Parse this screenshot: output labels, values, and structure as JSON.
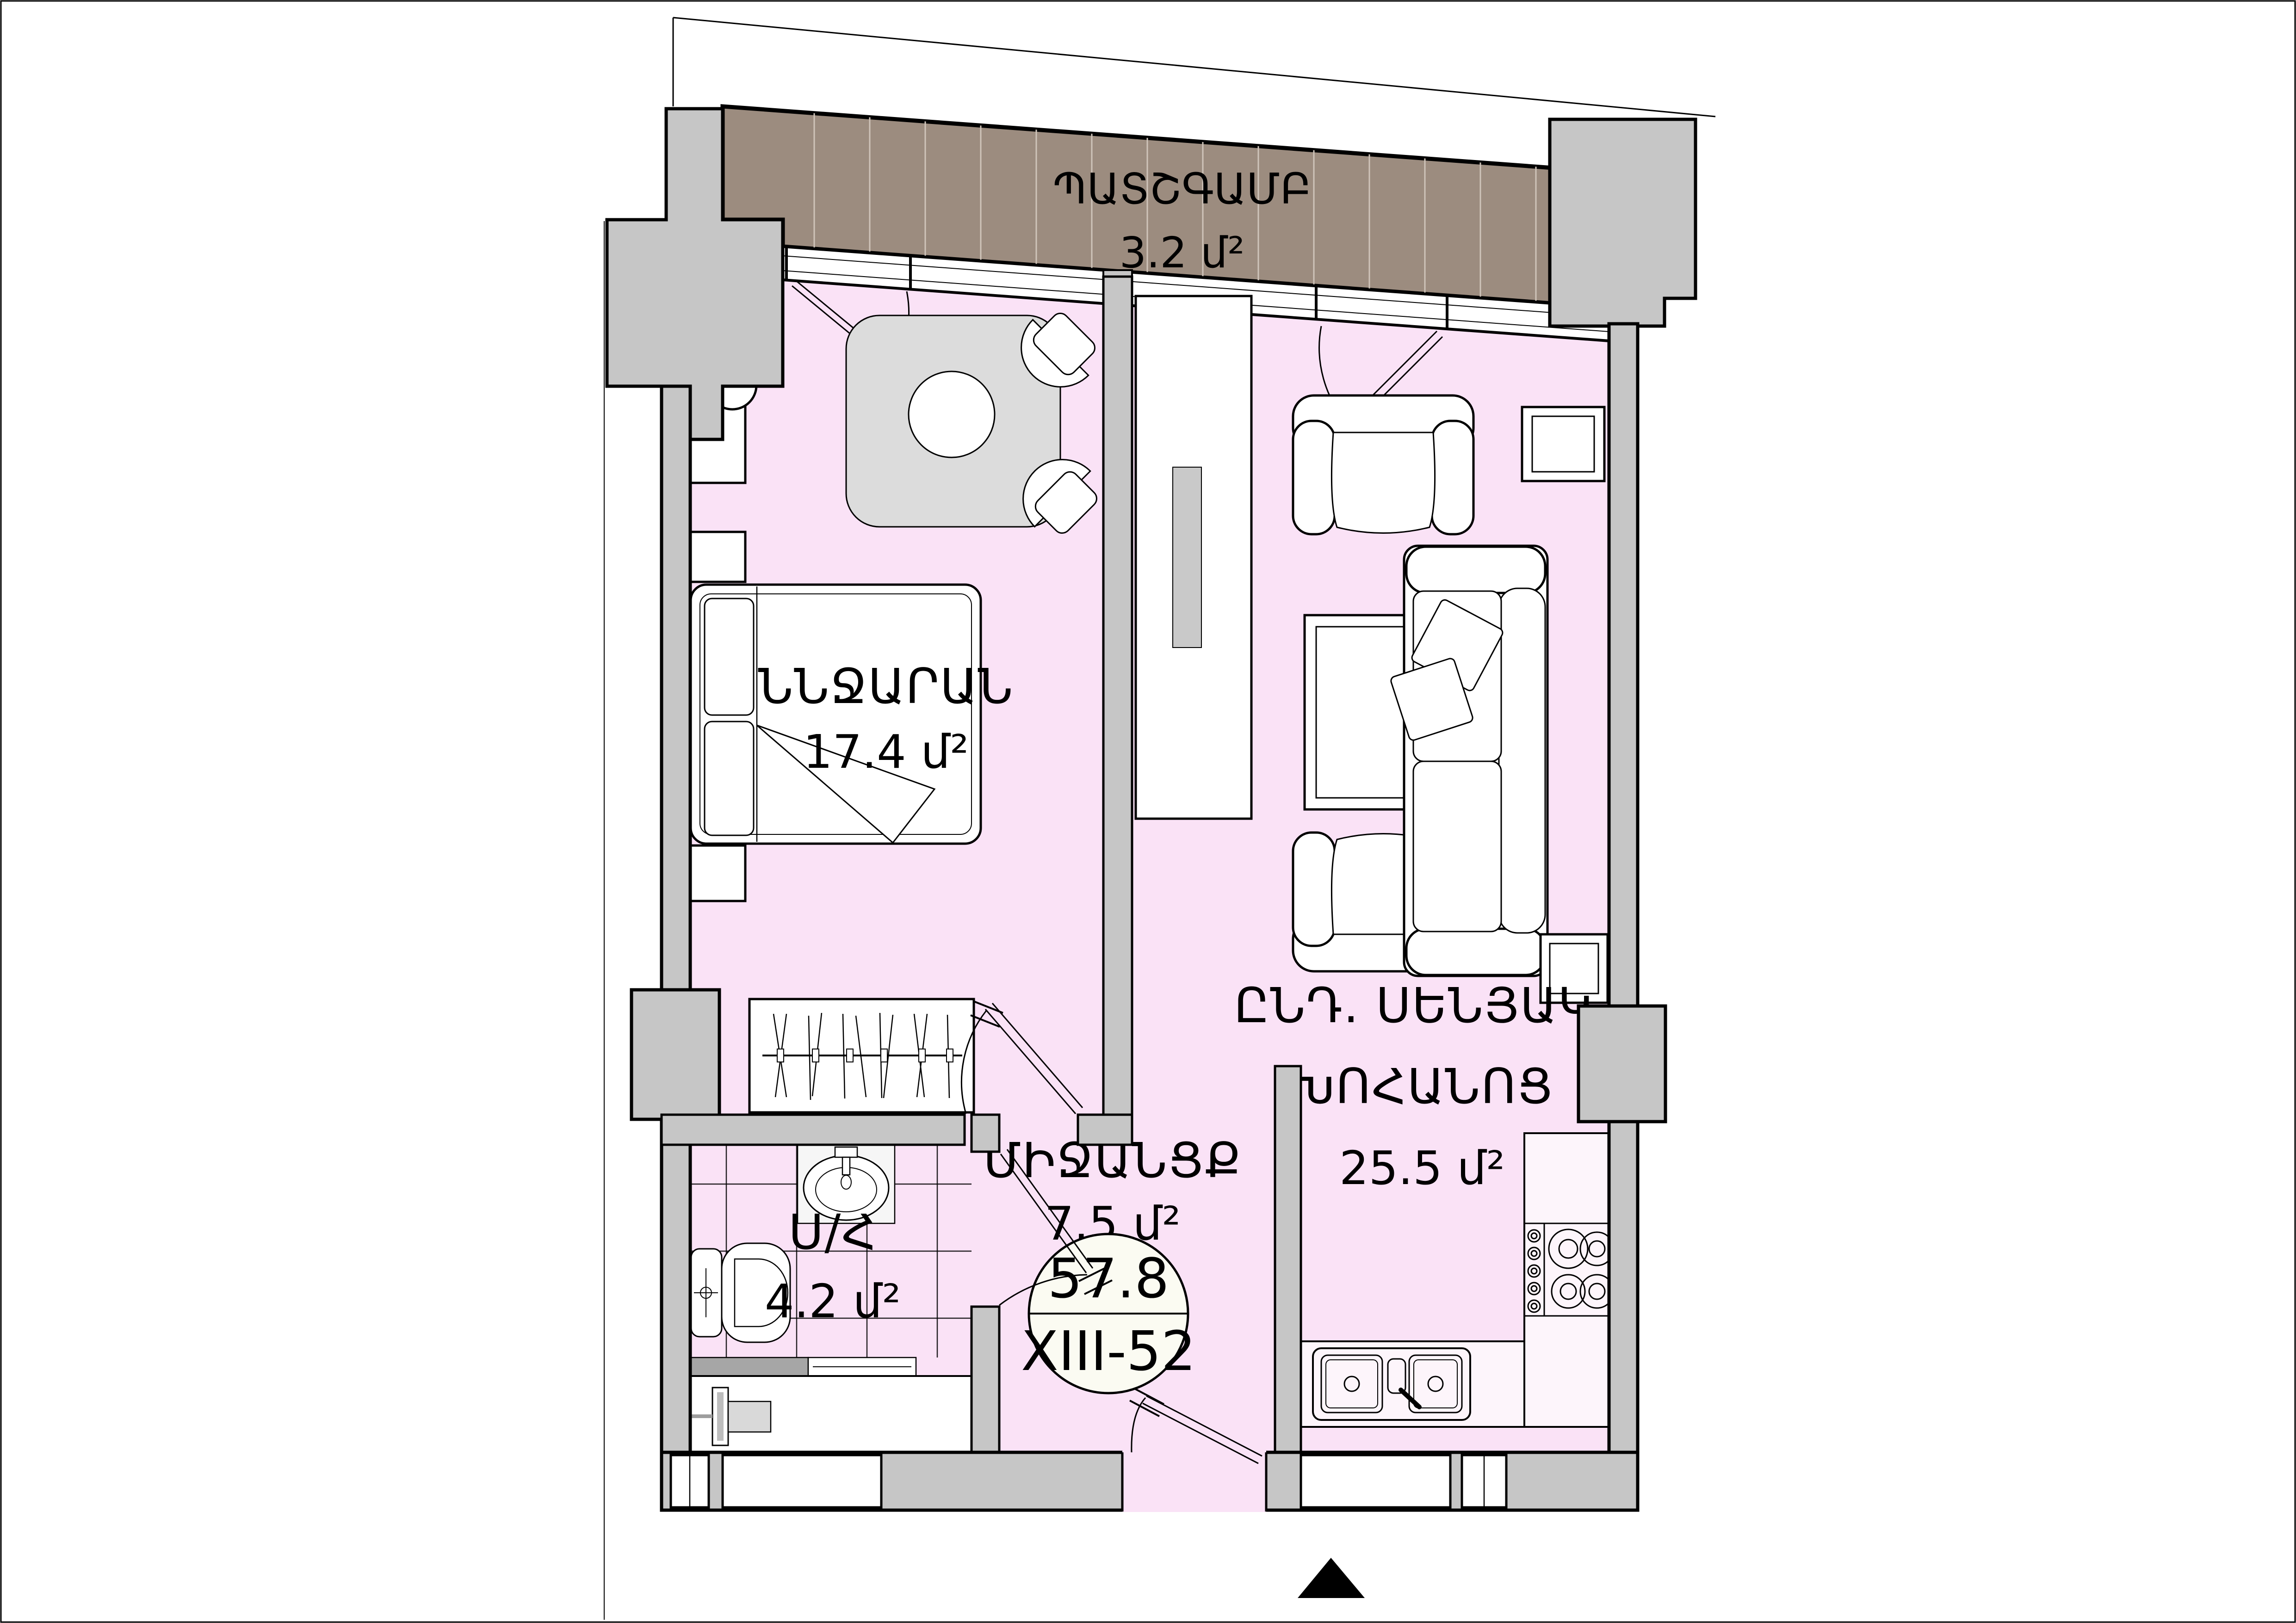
{
  "plan": {
    "title": "Apartment floor plan",
    "balcony": {
      "name": "ՊԱՏՇԳԱՄԲ",
      "area": "3.2 մ²"
    },
    "bedroom": {
      "name": "ՆՆՋԱՐԱՆ",
      "area": "17.4 մ²"
    },
    "living_kitchen": {
      "name_line1": "ԸՆԴ. ՍԵՆՅԱԿ,",
      "name_line2": "ԽՈՀԱՆՈՑ",
      "area": "25.5 մ²"
    },
    "bathroom": {
      "name": "Ս/Հ",
      "area": "4.2 մ²"
    },
    "hallway": {
      "name": "ՄԻՋԱՆՑՔ",
      "area": "7.5 մ²"
    },
    "unit_badge": {
      "total_area": "57.8",
      "unit_code": "XIII-52"
    },
    "colors": {
      "room_fill": "#FAE2F6",
      "balcony_fill": "#9C8C7F",
      "wall_fill": "#C6C6C6",
      "furniture_fill": "#FFFFFF",
      "rug_fill": "#DCDCDC",
      "line": "#000000"
    }
  }
}
